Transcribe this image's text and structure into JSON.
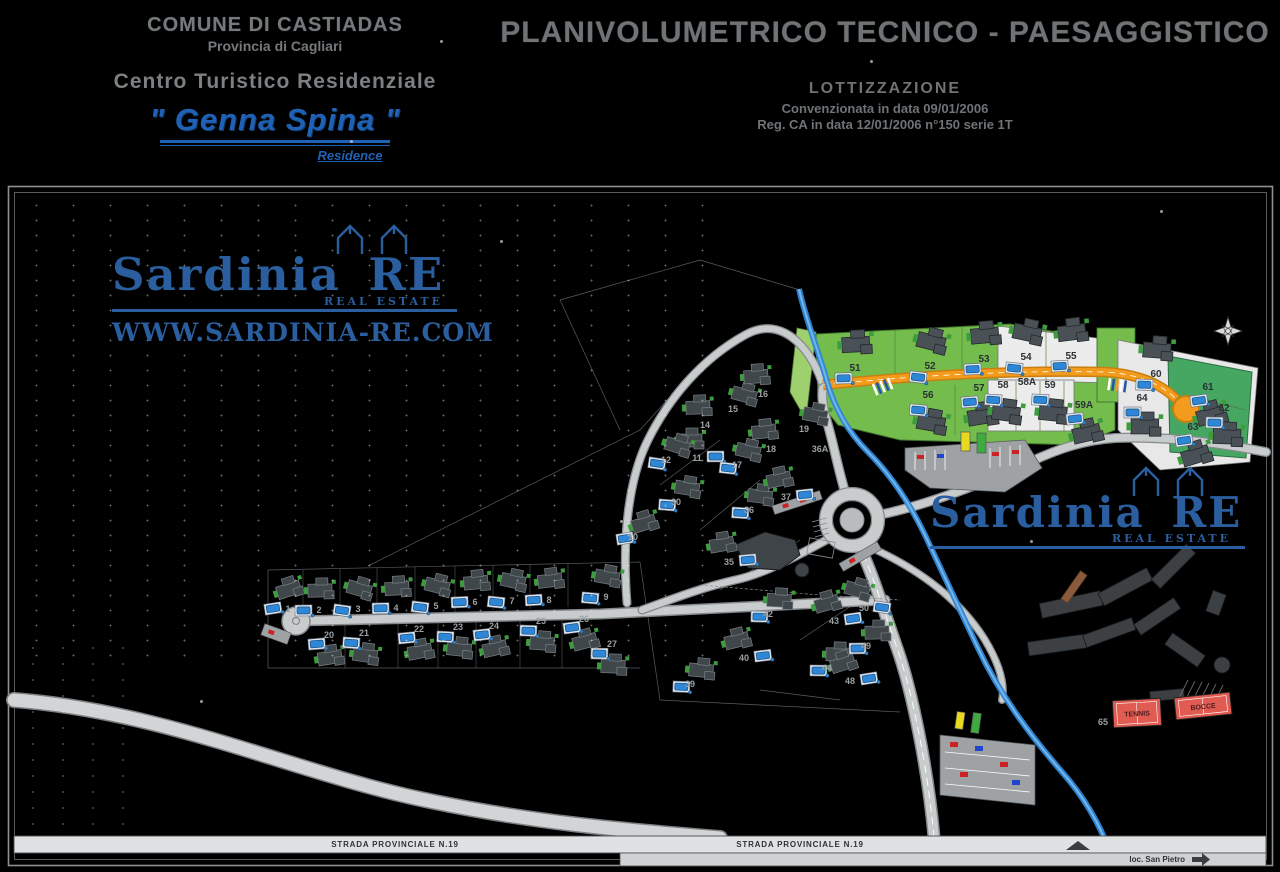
{
  "header": {
    "municipality": "COMUNE DI CASTIADAS",
    "province": "Provincia di Cagliari",
    "center_type": "Centro Turistico Residenziale",
    "resort_name": "\" Genna Spina \"",
    "resort_subtitle": "Residence",
    "main_title": "PLANIVOLUMETRICO TECNICO - PAESAGGISTICO",
    "subdivision_label": "LOTTIZZAZIONE",
    "convention_line": "Convenzionata in data 09/01/2006",
    "registration_line": "Reg. CA in data 12/01/2006 n°150 serie 1T"
  },
  "brand": {
    "name": "Sardinia RE",
    "tagline": "REAL ESTATE",
    "website": "WWW.SARDINIA-RE.COM"
  },
  "map": {
    "road_label": "STRADA PROVINCIALE N.19",
    "destination_label": "loc. San Pietro",
    "courts": [
      {
        "label": "TENNIS",
        "x": 1137,
        "y": 713,
        "w": 48,
        "h": 27,
        "rot": -3
      },
      {
        "label": "BOCCE",
        "x": 1203,
        "y": 706,
        "w": 56,
        "h": 22,
        "rot": -6
      }
    ],
    "lots": [
      {
        "n": "1",
        "x": 288,
        "y": 612
      },
      {
        "n": "2",
        "x": 319,
        "y": 613
      },
      {
        "n": "3",
        "x": 358,
        "y": 612
      },
      {
        "n": "4",
        "x": 396,
        "y": 611
      },
      {
        "n": "5",
        "x": 436,
        "y": 609
      },
      {
        "n": "6",
        "x": 475,
        "y": 605
      },
      {
        "n": "7",
        "x": 512,
        "y": 604
      },
      {
        "n": "8",
        "x": 549,
        "y": 603
      },
      {
        "n": "9",
        "x": 606,
        "y": 600
      },
      {
        "n": "20",
        "x": 329,
        "y": 638
      },
      {
        "n": "21",
        "x": 364,
        "y": 636
      },
      {
        "n": "22",
        "x": 419,
        "y": 632
      },
      {
        "n": "23",
        "x": 458,
        "y": 630
      },
      {
        "n": "24",
        "x": 494,
        "y": 629
      },
      {
        "n": "25",
        "x": 541,
        "y": 624
      },
      {
        "n": "26",
        "x": 584,
        "y": 622
      },
      {
        "n": "27",
        "x": 612,
        "y": 647
      },
      {
        "n": "10",
        "x": 633,
        "y": 540
      },
      {
        "n": "11",
        "x": 697,
        "y": 461
      },
      {
        "n": "12",
        "x": 666,
        "y": 463
      },
      {
        "n": "14",
        "x": 705,
        "y": 428
      },
      {
        "n": "15",
        "x": 733,
        "y": 412
      },
      {
        "n": "16",
        "x": 763,
        "y": 397
      },
      {
        "n": "17",
        "x": 737,
        "y": 468
      },
      {
        "n": "18",
        "x": 771,
        "y": 452
      },
      {
        "n": "19",
        "x": 804,
        "y": 432
      },
      {
        "n": "36A",
        "x": 820,
        "y": 452
      },
      {
        "n": "30",
        "x": 676,
        "y": 505
      },
      {
        "n": "35",
        "x": 729,
        "y": 565
      },
      {
        "n": "36",
        "x": 749,
        "y": 513
      },
      {
        "n": "37",
        "x": 786,
        "y": 500
      },
      {
        "n": "39",
        "x": 690,
        "y": 687
      },
      {
        "n": "40",
        "x": 744,
        "y": 661
      },
      {
        "n": "42",
        "x": 768,
        "y": 617
      },
      {
        "n": "43",
        "x": 834,
        "y": 624
      },
      {
        "n": "44",
        "x": 827,
        "y": 671
      },
      {
        "n": "48",
        "x": 850,
        "y": 684
      },
      {
        "n": "49",
        "x": 866,
        "y": 649
      },
      {
        "n": "50",
        "x": 864,
        "y": 611
      },
      {
        "n": "51",
        "x": 855,
        "y": 371,
        "z": "g"
      },
      {
        "n": "52",
        "x": 930,
        "y": 369,
        "z": "g"
      },
      {
        "n": "53",
        "x": 984,
        "y": 362,
        "z": "g"
      },
      {
        "n": "54",
        "x": 1026,
        "y": 360,
        "z": "w"
      },
      {
        "n": "55",
        "x": 1071,
        "y": 359,
        "z": "w"
      },
      {
        "n": "56",
        "x": 928,
        "y": 398,
        "z": "g"
      },
      {
        "n": "57",
        "x": 979,
        "y": 391,
        "z": "g"
      },
      {
        "n": "58",
        "x": 1003,
        "y": 388,
        "z": "w"
      },
      {
        "n": "58A",
        "x": 1027,
        "y": 385,
        "z": "w"
      },
      {
        "n": "59",
        "x": 1050,
        "y": 388,
        "z": "w"
      },
      {
        "n": "59A",
        "x": 1084,
        "y": 408,
        "z": "g"
      },
      {
        "n": "60",
        "x": 1156,
        "y": 377,
        "z": "w"
      },
      {
        "n": "61",
        "x": 1208,
        "y": 390,
        "z": "g2"
      },
      {
        "n": "62",
        "x": 1224,
        "y": 411,
        "z": "g2"
      },
      {
        "n": "63",
        "x": 1193,
        "y": 430,
        "z": "w"
      },
      {
        "n": "64",
        "x": 1142,
        "y": 401,
        "z": "w"
      },
      {
        "n": "65",
        "x": 1103,
        "y": 725
      }
    ],
    "colors": {
      "zone_green": "#74bd4d",
      "zone_green_light": "#9ed06e",
      "zone_green_dark": "#46a763",
      "road_orange": "#f29b1d",
      "water": "#2e86d6",
      "court_red": "#e05b52",
      "brand_blue": "#2a5e9e"
    }
  }
}
